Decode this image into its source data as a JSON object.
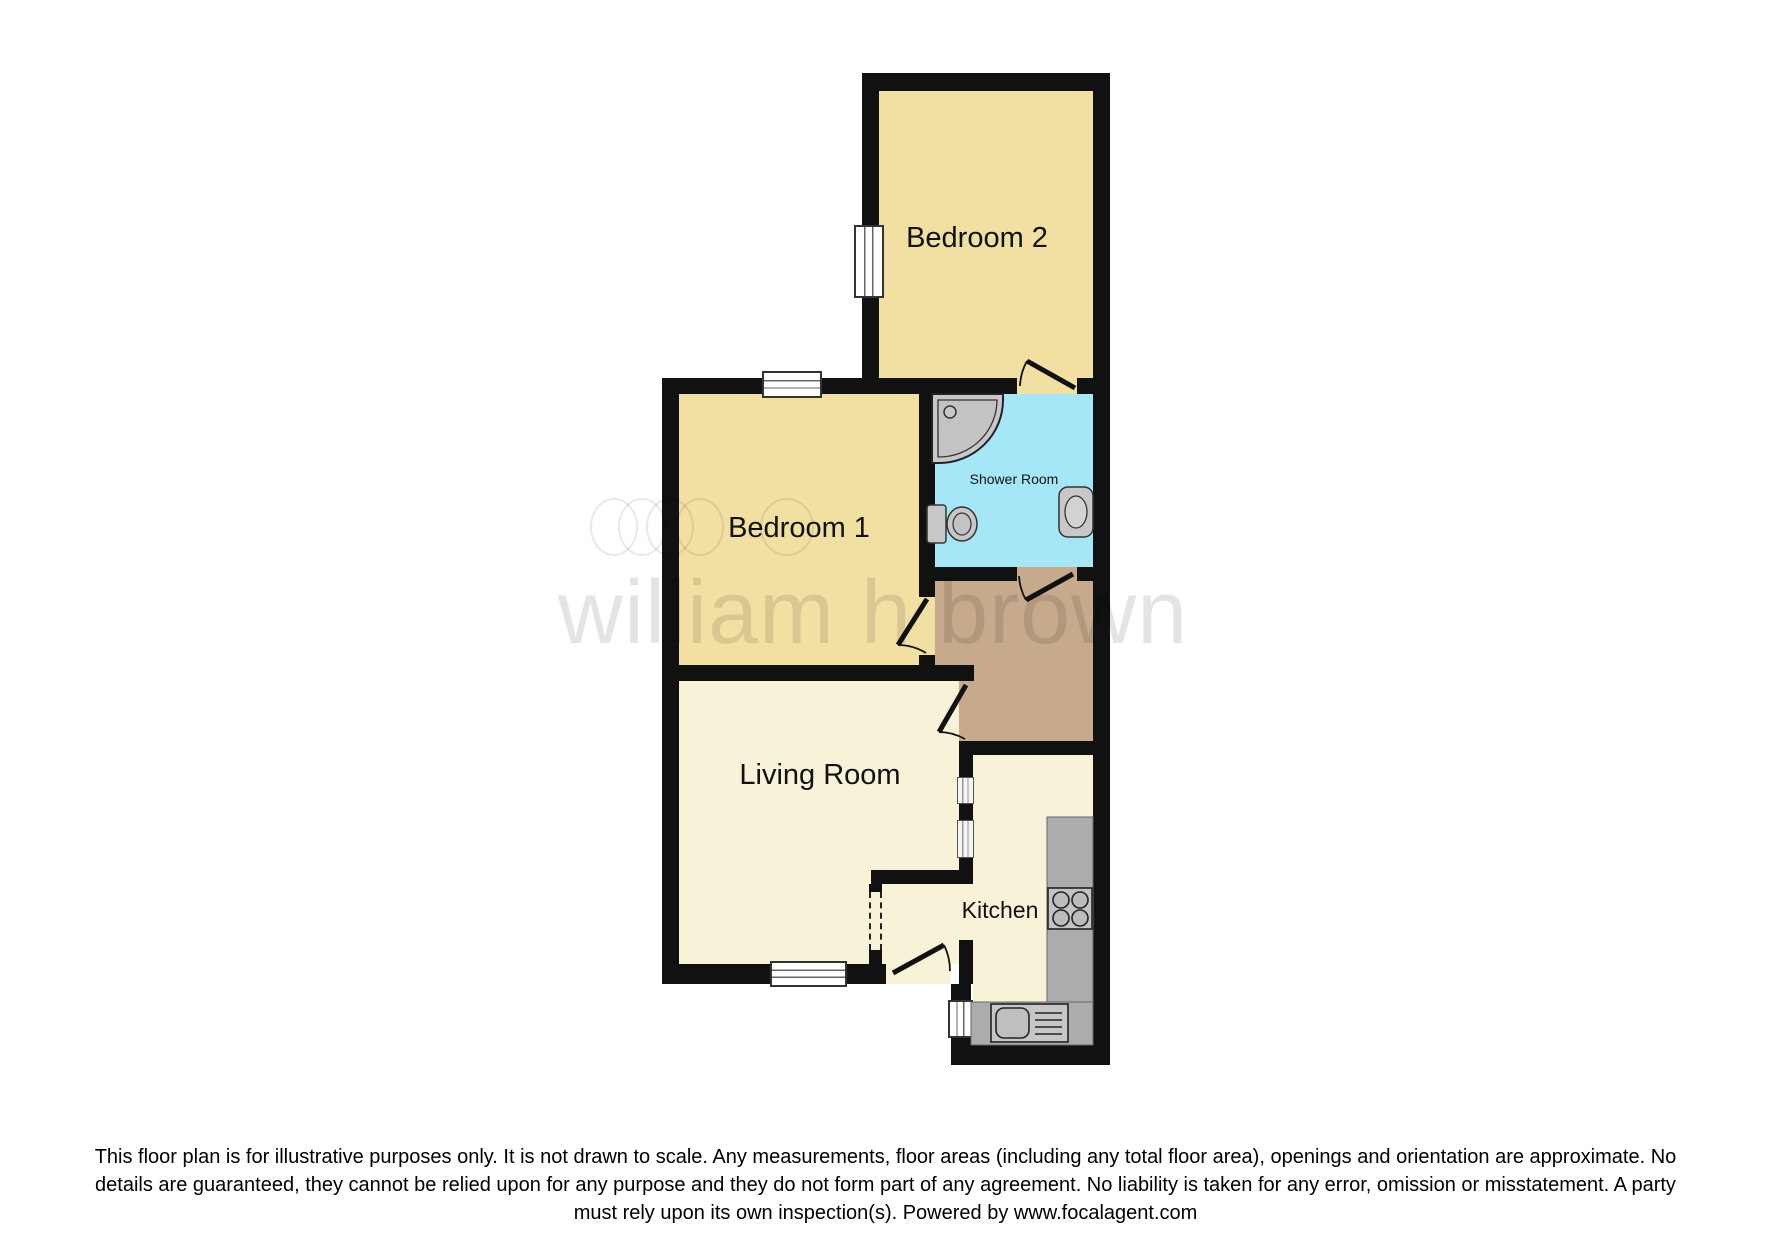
{
  "plan": {
    "type": "floorplan",
    "rooms": [
      {
        "id": "bedroom2",
        "label": "Bedroom 2",
        "floor_color": "#F2DFA2"
      },
      {
        "id": "bedroom1",
        "label": "Bedroom 1",
        "floor_color": "#F2DFA2"
      },
      {
        "id": "shower_room",
        "label": "Shower Room",
        "floor_color": "#A5E7F7"
      },
      {
        "id": "hallway",
        "label": "",
        "floor_color": "#C6AA8B"
      },
      {
        "id": "living_room",
        "label": "Living Room",
        "floor_color": "#F8F2D9"
      },
      {
        "id": "kitchen",
        "label": "Kitchen",
        "floor_color": "#F8F2D9"
      }
    ],
    "labels": {
      "bedroom2": "Bedroom 2",
      "bedroom1": "Bedroom 1",
      "shower_room": "Shower Room",
      "living_room": "Living Room",
      "kitchen": "Kitchen"
    },
    "fixtures": [
      "corner-shower",
      "toilet",
      "wash-basin",
      "kitchen-counter",
      "hob",
      "kitchen-sink"
    ],
    "colors": {
      "wall": "#111111",
      "bedroom_fill": "#F2DFA2",
      "shower_fill": "#A5E7F7",
      "hallway_fill": "#C6AA8B",
      "living_kitchen_fill": "#F8F2D9",
      "counter_gray": "#ACACAC",
      "fixture_gray": "#C8C8C8",
      "background": "#FFFFFF"
    }
  },
  "watermark": {
    "text": "william h brown"
  },
  "disclaimer": {
    "line1": "This floor plan is for illustrative purposes only. It is not drawn to scale. Any measurements, floor areas (including any total floor area), openings and orientation are approximate. No",
    "line2": "details are guaranteed, they cannot be relied upon for any purpose and they do not form part of any agreement. No liability is taken for any error, omission or misstatement. A party",
    "line3": "must rely upon its own inspection(s). Powered by www.focalagent.com"
  }
}
